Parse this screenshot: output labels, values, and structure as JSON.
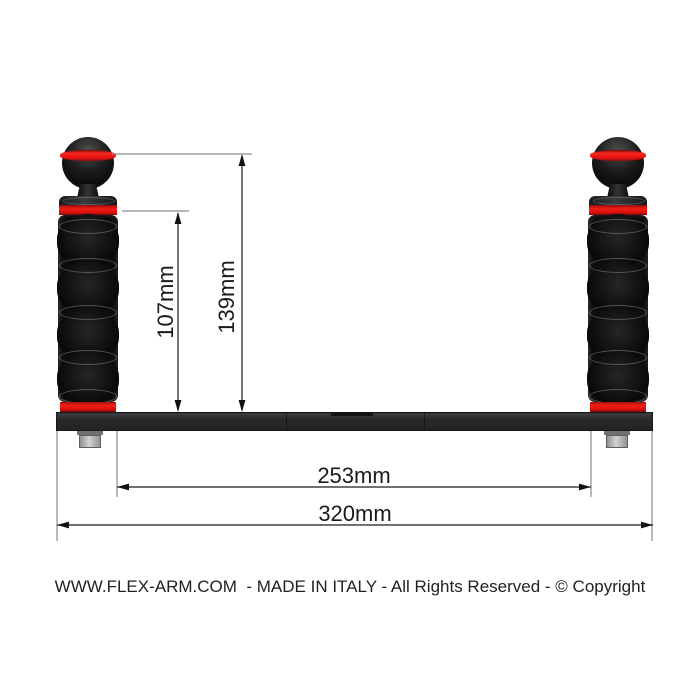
{
  "drawing": {
    "kind": "technical-dimension-drawing",
    "subject": "dual-handle camera tray with ball-joint flex arms",
    "units": "mm"
  },
  "dimensions": {
    "arm_top_to_tray": {
      "label": "107mm",
      "value": 107,
      "unit": "mm",
      "orientation": "vertical"
    },
    "ball_top_to_tray": {
      "label": "139mm",
      "value": 139,
      "unit": "mm",
      "orientation": "vertical"
    },
    "inner_span": {
      "label": "253mm",
      "value": 253,
      "unit": "mm",
      "orientation": "horizontal"
    },
    "tray_length": {
      "label": "320mm",
      "value": 320,
      "unit": "mm",
      "orientation": "horizontal"
    }
  },
  "footer": {
    "text": "WWW.FLEX-ARM.COM  - MADE IN ITALY - All Rights Reserved - © Copyright"
  },
  "colors": {
    "accent_red": "#e61310",
    "part_black": "#121212",
    "tray_gray": "#282a2b",
    "bolt_gray": "#b9bbbc",
    "dimension_line": "#1a1a1a",
    "extension_line": "#8c8c8c",
    "text": "#1a1a1a",
    "background": "#ffffff"
  }
}
